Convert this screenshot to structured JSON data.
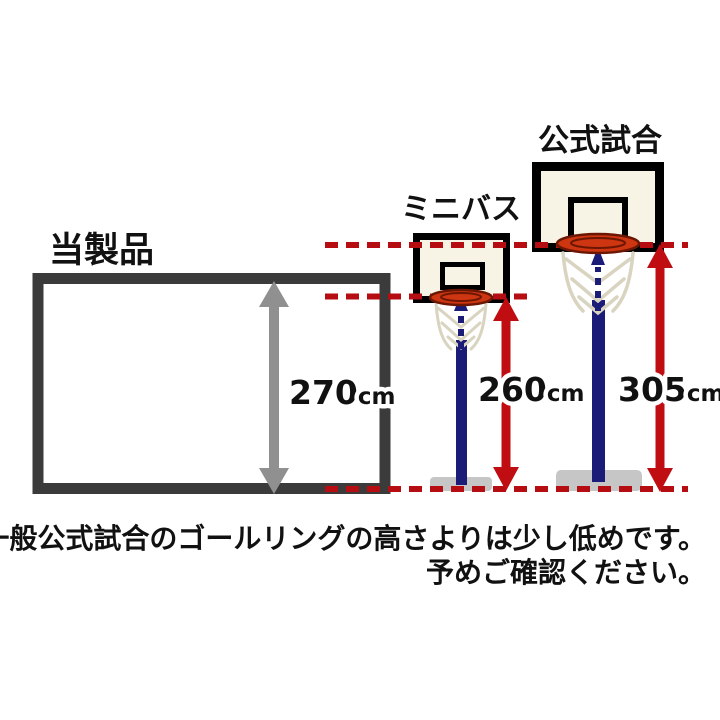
{
  "product": {
    "label": "当製品",
    "height_value": "270",
    "height_unit": "cm"
  },
  "minibas": {
    "label": "ミニバス",
    "height_value": "260",
    "height_unit": "cm"
  },
  "official": {
    "label": "公式試合",
    "height_value": "305",
    "height_unit": "cm"
  },
  "note": {
    "line1": "※一般公式試合のゴールリングの高さよりは少し低めです。",
    "line2": "予めご確認ください。"
  },
  "colors": {
    "dashed_line_red": "#b50d11",
    "arrow_red": "#c00d12",
    "pole_navy": "#1b1b78",
    "frame_dark_gray": "#3b3b3b",
    "arrow_gray": "#909090",
    "backboard_cream": "#f7f4e6",
    "rim_orange": "#ce3511",
    "base_gray": "#c6c6c6"
  }
}
